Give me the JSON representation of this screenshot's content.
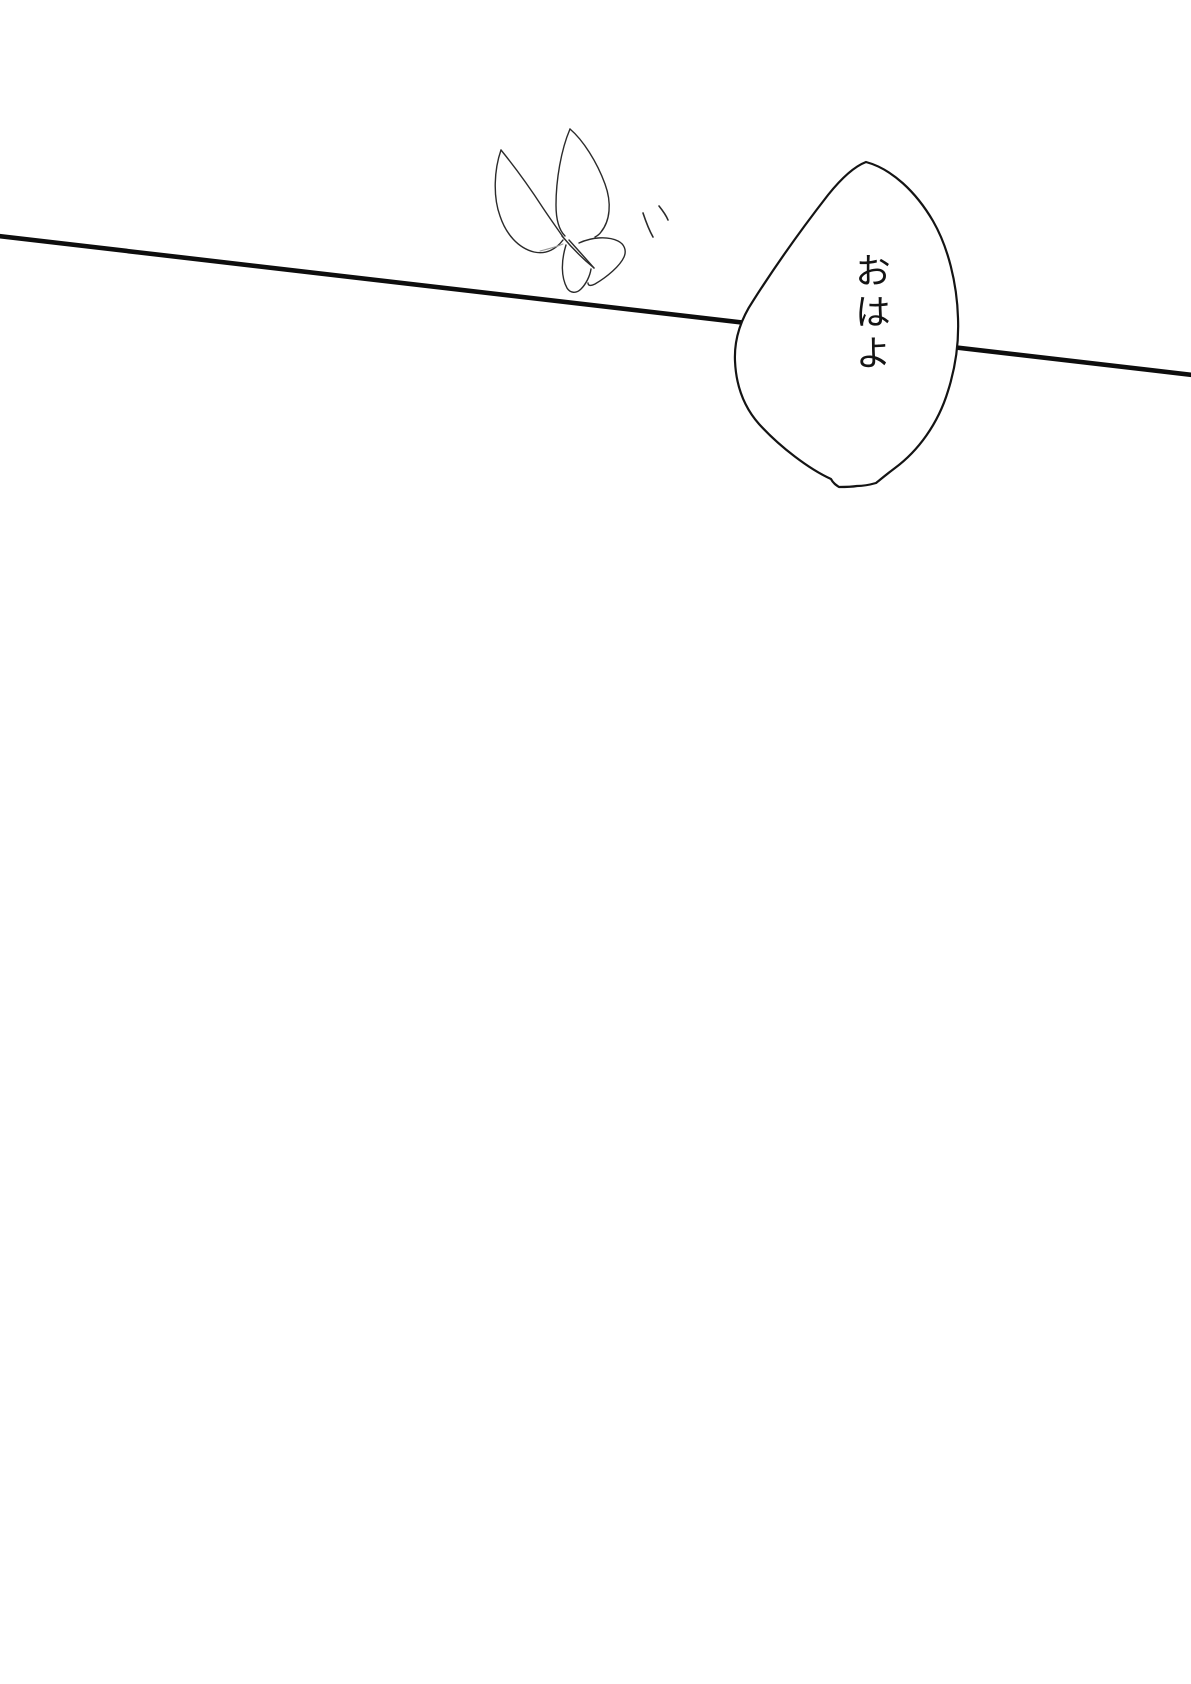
{
  "page": {
    "background_color": "#ffffff",
    "ink_color": "#141414"
  },
  "speech_bubble": {
    "text": "おはよ"
  },
  "artwork": {
    "butterfly_icon": "hand-drawn butterfly line sketch",
    "flutter_marks_icon": "two short motion tick strokes",
    "wire_line": "thin diagonal line crossing page behind speech bubble"
  }
}
